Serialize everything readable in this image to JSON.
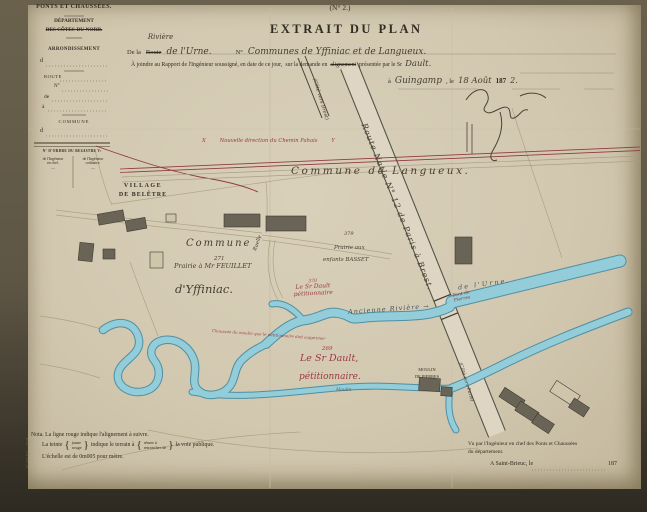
{
  "form": {
    "service": "PONTS ET CHAUSSÉES.",
    "departement_label": "DÉPARTEMENT",
    "departement_value": "DES CÔTES-DU-NORD.",
    "arrondissement_label": "ARRONDISSEMENT",
    "arrondissement_prefix": "d",
    "route_label": "ROUTE",
    "numero_label": "N°",
    "de_label": "de",
    "a_label": "à",
    "commune_label": "COMMUNE",
    "commune_prefix": "d",
    "registre_heading": "N° D'ORDRE DU REGISTRE V:",
    "registre_col1_l1": "de l'Ingénieur",
    "registre_col1_l2": "en chef.",
    "registre_col2_l1": "de l'Ingénieur",
    "registre_col2_l2": "ordinaire.",
    "dash": "—",
    "imprint": "N° 131. Typ. — Paris."
  },
  "header": {
    "form_number": "(N° 2.)",
    "title": "EXTRAIT DU PLAN",
    "line1_prefix": "De la",
    "line1_struck": "Route",
    "line1_over": "Rivière",
    "line1_hand1": "de l'Urne.",
    "line1_no": "N°",
    "line1_hand2": "Communes de Yffiniac et de Langueux.",
    "line2_a": "À joindre au Rapport de l'Ingénieur soussigné, en date de ce jour,",
    "line2_b": "sur la demande en",
    "line2_struck": "alignement",
    "line2_c": "présentée par le Sr",
    "line2_hand": "Dault.",
    "line3_a": "à",
    "line3_hand1": "Guingamp",
    "line3_b": ", le",
    "line3_hand2": "18 Août",
    "line3_year": "187",
    "line3_year_hand": "2."
  },
  "map": {
    "red_point_x": "X",
    "red_alignment_label": "Nouvelle direction du Chemin Fahais",
    "red_point_y": "Y",
    "cote_brest": "(Côté vers Brest)",
    "route_nationale": "Route Natle N° 12 de Paris à Brest.",
    "commune_langueux": "Commune  de  Langueux.",
    "village_l1": "VILLAGE",
    "village_l2": "DE BELÊTRE",
    "commune_yffiniac": "Commune",
    "parcel_271": "271",
    "prairie_feuillet": "Prairie à Mr FEUILLET",
    "yffiniac": "d'Yffiniac.",
    "parcel_379": "379",
    "prairie_basset_l1": "Prairie aux",
    "prairie_basset_l2": "enfants BASSET",
    "parcel_370": "370",
    "dault_small_l1": "Le Sr Dault",
    "dault_small_l2": "pétitionnaire",
    "riviere_label": "Ancienne  Rivière  →",
    "urne_label": "de   l'Urne.",
    "pont_l1": "Pont de",
    "pont_l2": "Pierres",
    "causeway_note": "Chaussée du moulin que le pétitionnaire doit supprimer",
    "parcel_269": "269",
    "dault_big_l1": "Le Sr Dault,",
    "dault_big_l2": "pétitionnaire.",
    "moulin_l1": "MOULIN",
    "moulin_l2": "DE PIERRES",
    "cote_paris": "(Côté vers Paris)",
    "ruelle": "Ruelle",
    "moulin_small": "Moulin"
  },
  "notes": {
    "nota": "Nota.  La ligne rouge indique l'alignement à suivre.",
    "tint_pre": "La teinte",
    "brace_open": "{",
    "brace_close": "}",
    "tint_opt1": "jaune",
    "tint_opt2": "rouge",
    "tint_mid": "indique le terrain à",
    "tint_act1": "réunir à",
    "tint_act2": "retrancher de",
    "tint_post": "la voie publique.",
    "scale": "L'échelle est de 0m005 pour mètre."
  },
  "approval": {
    "vu_l1": "Vu par l'Ingénieur en chef des Ponts et Chaussées",
    "vu_l2": "du département.",
    "place": "A Saint-Brieuc, le",
    "year": "187"
  },
  "colors": {
    "red_ink": "#993a43",
    "blue_river": "#93cdda",
    "paper": "#d2c8b0"
  }
}
